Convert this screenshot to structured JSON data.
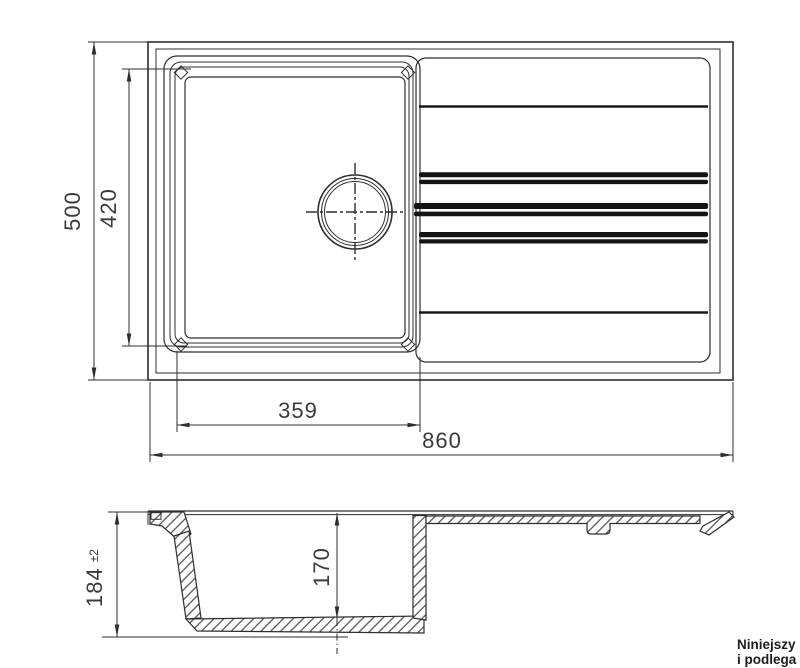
{
  "top_view": {
    "overall_width_mm": "860",
    "overall_depth_mm": "500",
    "bowl_width_mm": "359",
    "bowl_depth_mm": "420"
  },
  "section_view": {
    "total_height_mm": "184",
    "total_height_tolerance": "±2",
    "bowl_inner_depth_mm": "170"
  },
  "footer_note": {
    "line1": "Niniejszy",
    "line2": "i podlega"
  },
  "colors": {
    "line": "#2e2e2e",
    "dimension_text": "#3a3a3a",
    "groove_bars": "#141414",
    "background": "#ffffff"
  }
}
